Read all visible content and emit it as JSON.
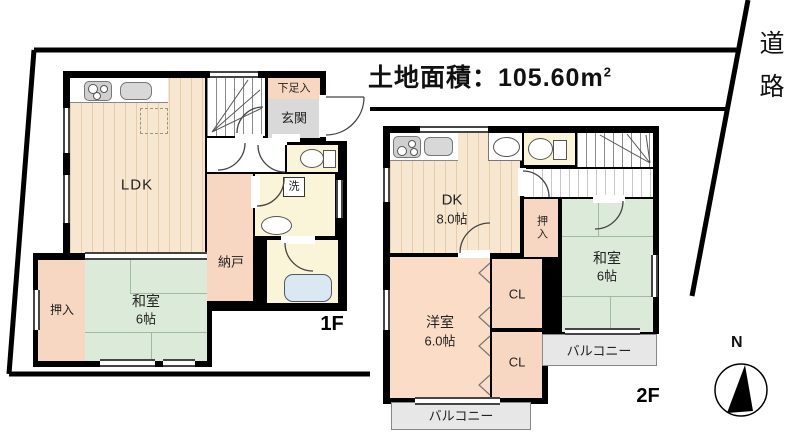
{
  "site": {
    "area_label_prefix": "土地面積：105.60",
    "area_unit": "m",
    "area_unit_exp": "2",
    "road_label": "道路"
  },
  "compass": {
    "north_label": "N"
  },
  "floor1": {
    "floor_label": "1F",
    "ldk_label": "LDK",
    "washitsu_name": "和室",
    "washitsu_size": "6帖",
    "oshiire_label": "押入",
    "nando_label": "納戸",
    "genkan_label": "玄関",
    "shoe_label": "下足入",
    "wash_label": "洗"
  },
  "floor2": {
    "floor_label": "2F",
    "dk_name": "DK",
    "dk_size": "8.0帖",
    "washitsu_name": "和室",
    "washitsu_size": "6帖",
    "oshiire_label": "押入",
    "closet1_label": "CL",
    "closet2_label": "CL",
    "youshitsu_name": "洋室",
    "youshitsu_size": "6.0帖",
    "balcony_right_label": "バルコニー",
    "balcony_bottom_label": "バルコニー"
  },
  "colors": {
    "wall": "#000000",
    "wood_floor": "#f8e7d0",
    "tatami": "#dcead9",
    "closet": "#f8d7c2",
    "sanitary": "#faf5d8",
    "entrance": "#d9d9d9",
    "balcony": "#e7e7e7",
    "bathtub": "#d9e8f1"
  }
}
